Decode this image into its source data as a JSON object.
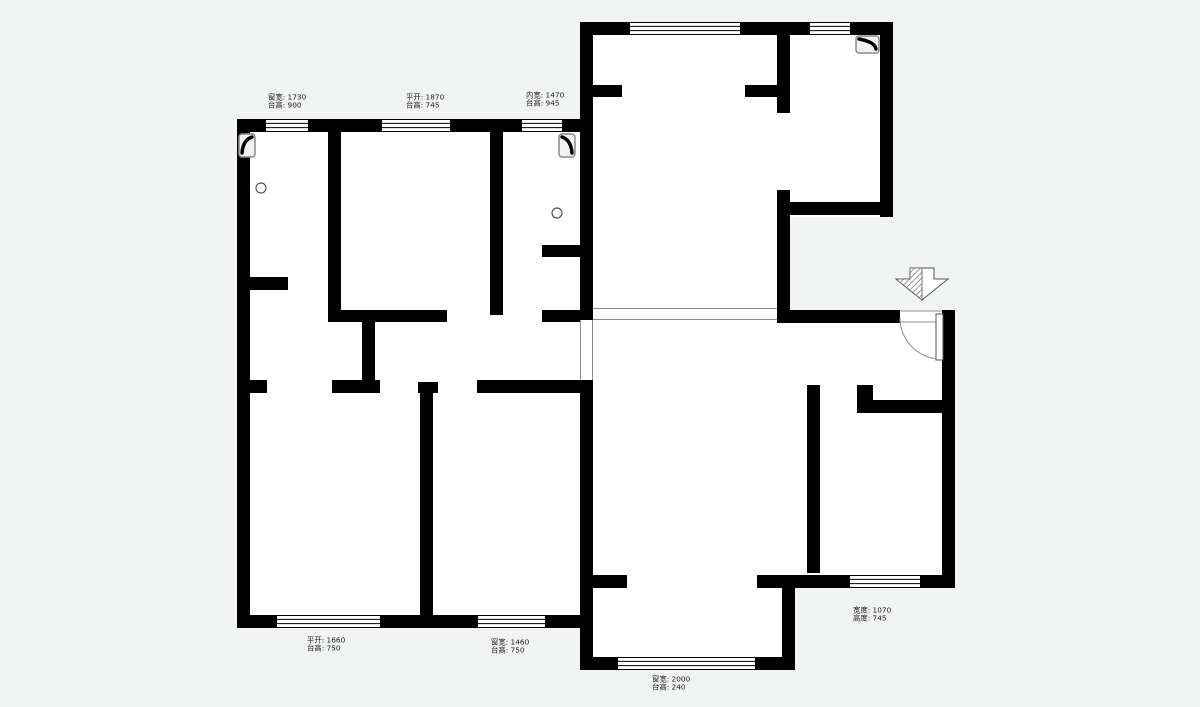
{
  "page": {
    "type": "architectural-floor-plan",
    "background_color": "#f2f3f3",
    "floor_color": "#ffffff",
    "wall_color": "#000000",
    "thin_line_color": "#8d8d8d",
    "annotation_color": "#191919"
  },
  "plan": {
    "canvas": {
      "width": 1200,
      "height": 707
    },
    "floor_fills": [
      [
        237,
        119,
        356,
        509
      ],
      [
        580,
        22,
        313,
        195
      ],
      [
        580,
        217,
        210,
        103
      ],
      [
        593,
        310,
        362,
        278
      ],
      [
        580,
        380,
        215,
        290
      ]
    ],
    "walls": [
      [
        237,
        119,
        356,
        13
      ],
      [
        237,
        119,
        13,
        509
      ],
      [
        237,
        615,
        356,
        13
      ],
      [
        580,
        22,
        313,
        13
      ],
      [
        880,
        22,
        13,
        195
      ],
      [
        580,
        22,
        13,
        110
      ],
      [
        580,
        132,
        13,
        188
      ],
      [
        580,
        380,
        13,
        290
      ],
      [
        580,
        657,
        215,
        13
      ],
      [
        782,
        588,
        13,
        82
      ],
      [
        593,
        575,
        34,
        13
      ],
      [
        757,
        575,
        38,
        13
      ],
      [
        795,
        575,
        160,
        13
      ],
      [
        942,
        310,
        13,
        278
      ],
      [
        777,
        310,
        123,
        13
      ],
      [
        777,
        35,
        13,
        78
      ],
      [
        593,
        85,
        29,
        12
      ],
      [
        745,
        85,
        32,
        12
      ],
      [
        790,
        202,
        103,
        13
      ],
      [
        777,
        190,
        13,
        133
      ],
      [
        807,
        385,
        13,
        188
      ],
      [
        857,
        385,
        16,
        28
      ],
      [
        873,
        400,
        82,
        13
      ],
      [
        328,
        132,
        13,
        180
      ],
      [
        237,
        277,
        51,
        13
      ],
      [
        328,
        310,
        119,
        12
      ],
      [
        542,
        310,
        51,
        12
      ],
      [
        542,
        245,
        38,
        12
      ],
      [
        490,
        132,
        13,
        183
      ],
      [
        362,
        322,
        13,
        58
      ],
      [
        332,
        380,
        48,
        13
      ],
      [
        237,
        380,
        30,
        13
      ],
      [
        418,
        382,
        20,
        11
      ],
      [
        477,
        380,
        116,
        13
      ],
      [
        420,
        393,
        13,
        222
      ]
    ],
    "windows": [
      [
        266,
        119,
        42,
        13
      ],
      [
        382,
        119,
        68,
        13
      ],
      [
        522,
        119,
        40,
        13
      ],
      [
        630,
        22,
        110,
        13
      ],
      [
        810,
        22,
        40,
        13
      ],
      [
        277,
        615,
        103,
        13
      ],
      [
        478,
        615,
        67,
        13
      ],
      [
        850,
        575,
        70,
        13
      ],
      [
        618,
        657,
        137,
        13
      ]
    ],
    "openings": [
      [
        593,
        308,
        184,
        12
      ],
      [
        580,
        320,
        13,
        60
      ]
    ],
    "door": {
      "threshold": [
        900,
        310,
        42,
        13
      ],
      "leaf": [
        936,
        314,
        7,
        46
      ],
      "arc": "M 900 318 A 41 41 0 0 0 941 359"
    },
    "entrance_arrow": {
      "outline": "M 910 268 L 934 268 L 934 279 L 948 279 L 922 300 L 896 279 L 910 279 Z",
      "hatch_half": "M 910 268 L 922 268 L 922 300 L 896 279 L 910 279 Z"
    },
    "fixtures": [
      {
        "x": 239,
        "y": 134,
        "w": 16,
        "h": 23,
        "orient": "tl"
      },
      {
        "x": 559,
        "y": 134,
        "w": 16,
        "h": 23,
        "orient": "tr"
      },
      {
        "x": 856,
        "y": 36,
        "w": 23,
        "h": 17,
        "orient": "tr"
      }
    ],
    "circles": [
      [
        261,
        188,
        5
      ],
      [
        557,
        213,
        5
      ]
    ],
    "annotations": [
      {
        "x": 268,
        "y": 93,
        "line1": "窗宽: 1730",
        "line2": "台高: 900"
      },
      {
        "x": 406,
        "y": 93,
        "line1": "平开: 1870",
        "line2": "台高: 745"
      },
      {
        "x": 526,
        "y": 91,
        "line1": "内宽: 1470",
        "line2": "台高: 945"
      },
      {
        "x": 307,
        "y": 636,
        "line1": "平开: 1660",
        "line2": "台高: 750"
      },
      {
        "x": 491,
        "y": 638,
        "line1": "窗宽: 1460",
        "line2": "台高: 750"
      },
      {
        "x": 652,
        "y": 675,
        "line1": "窗宽: 2000",
        "line2": "台高: 240"
      },
      {
        "x": 853,
        "y": 606,
        "line1": "宽度: 1070",
        "line2": "高度: 745"
      }
    ]
  }
}
